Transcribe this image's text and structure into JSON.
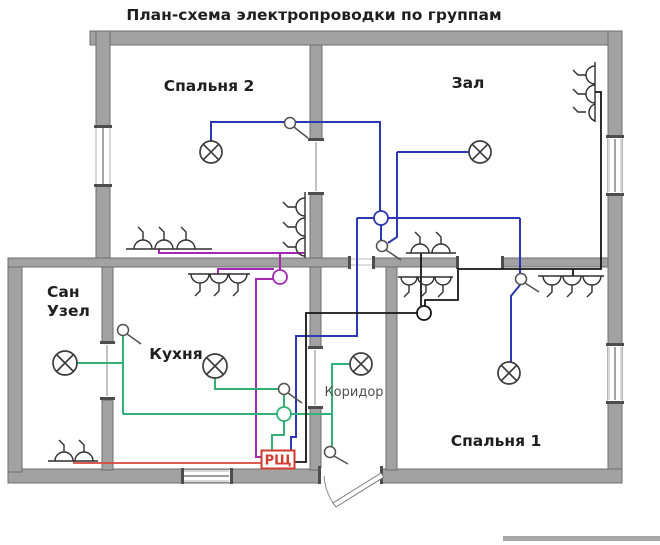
{
  "title": "План-схема электропроводки по группам",
  "rooms": {
    "bedroom2": "Спальня 2",
    "hall": "Зал",
    "bathroom": [
      "Сан",
      "Узел"
    ],
    "kitchen": "Кухня",
    "corridor": "Коридор",
    "bedroom1": "Спальня 1"
  },
  "panel": {
    "label": "РЩ"
  },
  "colors": {
    "wall": "#a2a2a2",
    "wall_border": "#6f6f6f",
    "wire_blue": "#2a38b4",
    "wire_purple": "#a428b2",
    "wire_green": "#33b076",
    "wire_black": "#161616",
    "wire_red": "#d6483c",
    "panel_red": "#d23c30",
    "symbol": "#3d3d3d",
    "label_dark": "#1f1f1f",
    "label_gray": "#4f4f4f"
  }
}
